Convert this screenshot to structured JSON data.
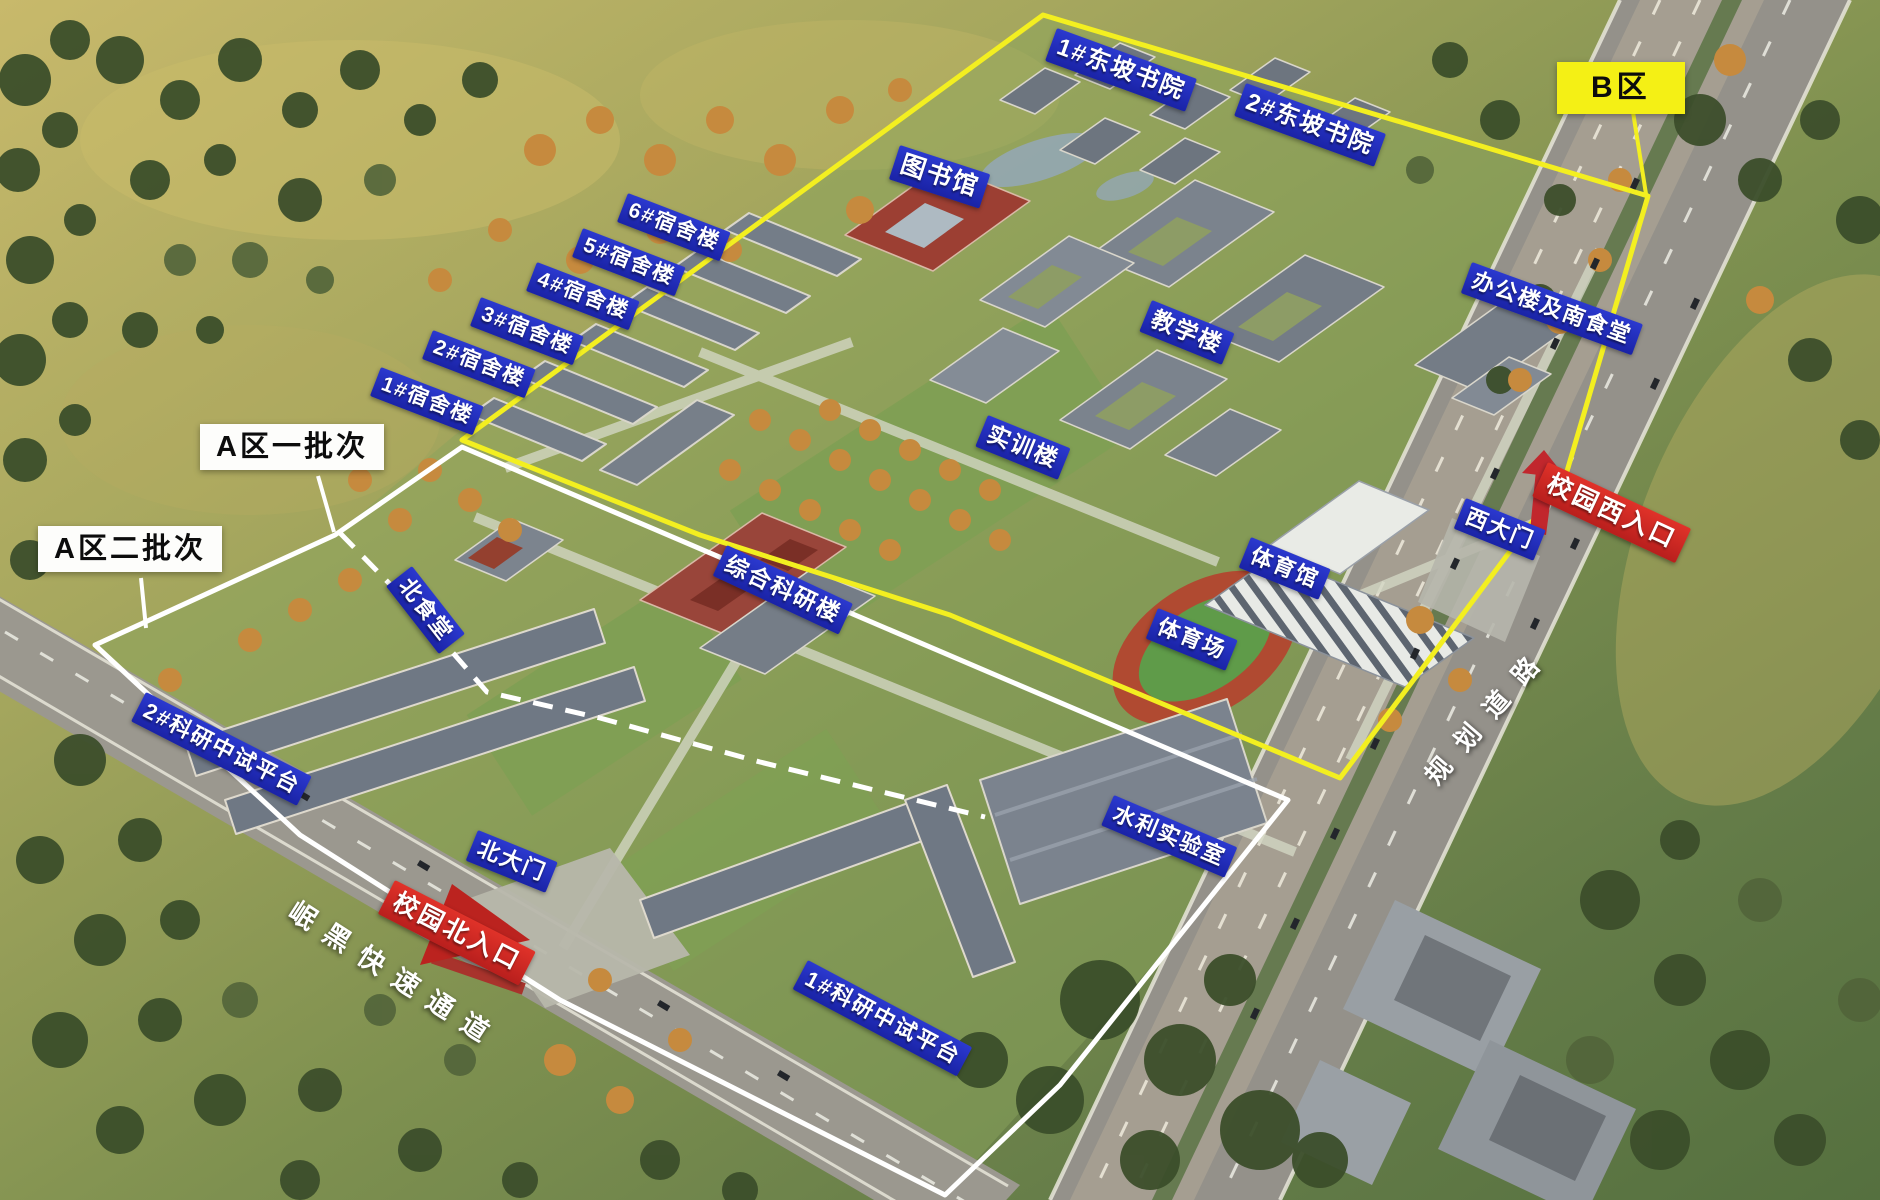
{
  "zones": [
    {
      "id": "zone-b",
      "label": "B区",
      "box_color": "#f4f015",
      "boundary_color": "#f3ef20",
      "boundary_style": "solid"
    },
    {
      "id": "zone-a-batch-1",
      "label": "A区一批次",
      "box_color": "#ffffff",
      "boundary_color": "#ffffff",
      "boundary_style": "solid"
    },
    {
      "id": "zone-a-batch-2",
      "label": "A区二批次",
      "box_color": "#ffffff",
      "boundary_color": "#ffffff",
      "boundary_style": "dashed-divider"
    }
  ],
  "buildings": [
    {
      "label": "1#东坡书院"
    },
    {
      "label": "2#东坡书院"
    },
    {
      "label": "图书馆"
    },
    {
      "label": "6#宿舍楼"
    },
    {
      "label": "5#宿舍楼"
    },
    {
      "label": "4#宿舍楼"
    },
    {
      "label": "3#宿舍楼"
    },
    {
      "label": "2#宿舍楼"
    },
    {
      "label": "1#宿舍楼"
    },
    {
      "label": "办公楼及南食堂"
    },
    {
      "label": "教学楼"
    },
    {
      "label": "实训楼"
    },
    {
      "label": "北食堂"
    },
    {
      "label": "综合科研楼"
    },
    {
      "label": "西大门"
    },
    {
      "label": "体育馆"
    },
    {
      "label": "体育场"
    },
    {
      "label": "2#科研中试平台"
    },
    {
      "label": "北大门"
    },
    {
      "label": "水利实验室"
    },
    {
      "label": "1#科研中试平台"
    }
  ],
  "entrances": [
    {
      "label": "校园西入口",
      "arrow": "up-left",
      "color": "#c1272d"
    },
    {
      "label": "校园北入口",
      "arrow": "up",
      "color": "#bb231f"
    }
  ],
  "roads": [
    {
      "label": "岷黑快速通道"
    },
    {
      "label": "规划道路"
    }
  ],
  "colors": {
    "building_label_bg": "#1d2ab5",
    "entrance_label_bg": "#cf2823",
    "zone_b_yellow": "#f4f015",
    "zone_a_white": "#ffffff",
    "road_text": "#ffffff"
  }
}
